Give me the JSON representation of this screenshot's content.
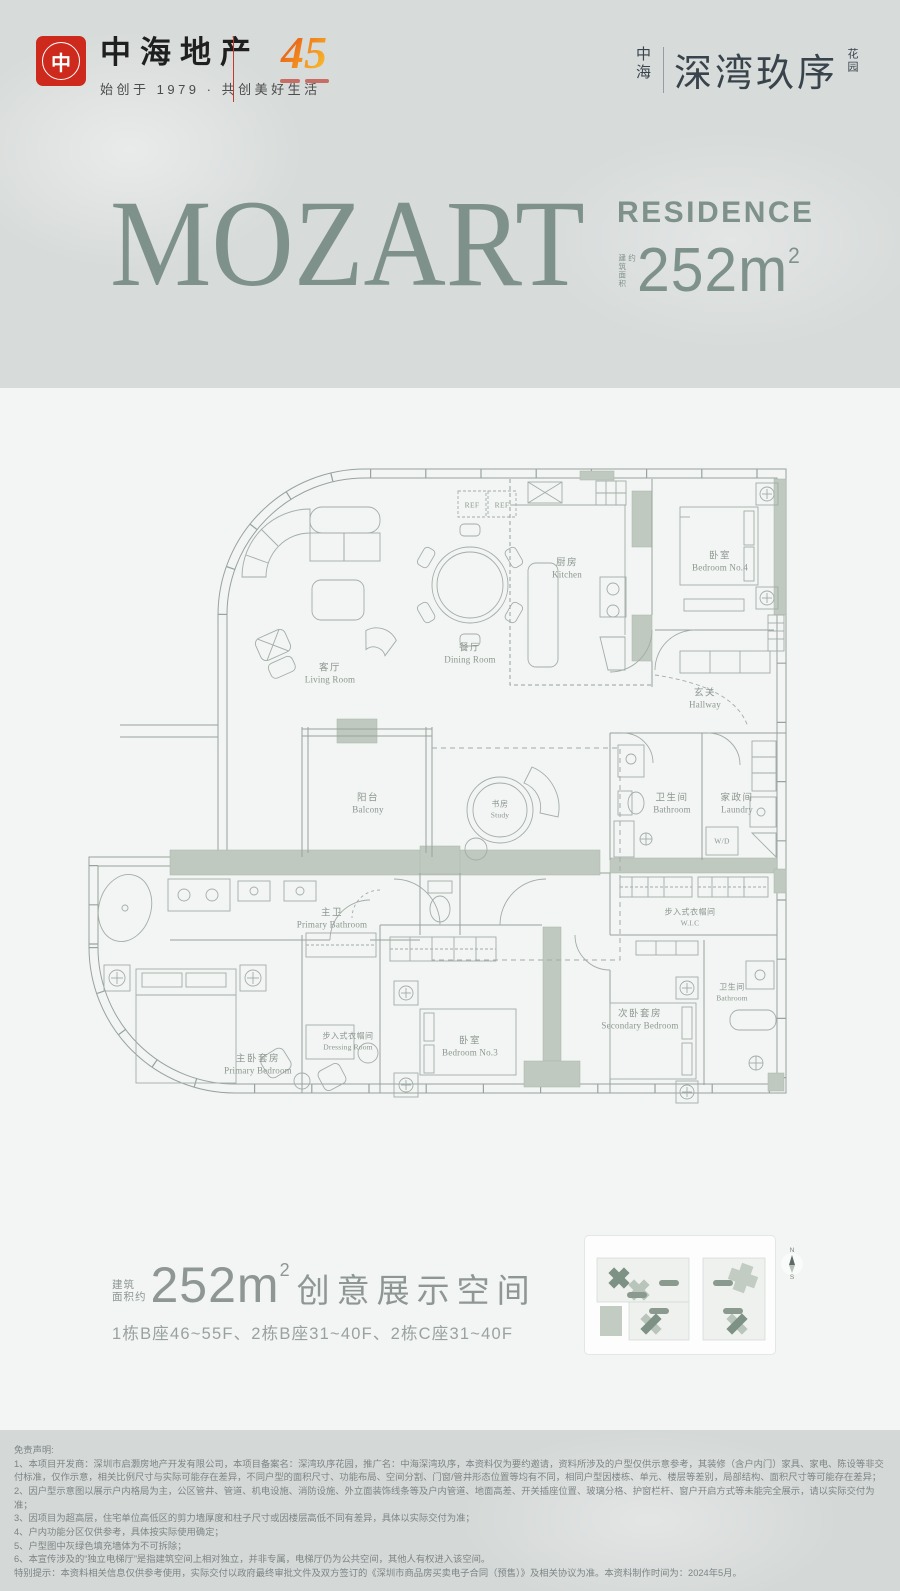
{
  "header": {
    "brand": {
      "logo_glyph": "中",
      "name": "中海地产",
      "tagline": "始创于 1979 · 共创美好生活",
      "anniversary": "45"
    },
    "project": {
      "prefix": "中海",
      "name": "深湾玖序",
      "suffix": "花园"
    }
  },
  "hero": {
    "title": "MOZART",
    "subtitle": "RESIDENCE",
    "area_label": "建筑面积约",
    "area_value": "252m",
    "area_sup": "2"
  },
  "plan": {
    "ref_label": "REF",
    "wd_label": "W/D",
    "rooms": [
      {
        "zh": "客厅",
        "en": "Living Room"
      },
      {
        "zh": "餐厅",
        "en": "Dining Room"
      },
      {
        "zh": "厨房",
        "en": "Kitchen"
      },
      {
        "zh": "卧室",
        "en": "Bedroom No.4"
      },
      {
        "zh": "玄关",
        "en": "Hallway"
      },
      {
        "zh": "阳台",
        "en": "Balcony"
      },
      {
        "zh": "书房",
        "en": "Study"
      },
      {
        "zh": "卫生间",
        "en": "Bathroom"
      },
      {
        "zh": "家政间",
        "en": "Laundry"
      },
      {
        "zh": "主卫",
        "en": "Primary Bathroom"
      },
      {
        "zh": "主卧套房",
        "en": "Primary Bedroom"
      },
      {
        "zh": "步入式衣帽间",
        "en": "Dressing Room"
      },
      {
        "zh": "卧室",
        "en": "Bedroom No.3"
      },
      {
        "zh": "次卧套房",
        "en": "Secondary Bedroom"
      },
      {
        "zh": "步入式衣帽间",
        "en": "W.I.C"
      },
      {
        "zh": "卫生间",
        "en": "Bathroom"
      }
    ]
  },
  "caption": {
    "area_label_l1": "建筑",
    "area_label_l2": "面积约",
    "area_value": "252m",
    "area_sup": "2",
    "title": "创意展示空间",
    "floors": "1栋B座46~55F、2栋B座31~40F、2栋C座31~40F"
  },
  "keyplan": {
    "north": "N",
    "south": "S"
  },
  "footer": {
    "title": "免责声明:",
    "lines": [
      "1、本项目开发商：深圳市启灏房地产开发有限公司，本项目备案名：深湾玖序花园，推广名：中海深湾玖序，本资料仅为要约邀请，资料所涉及的户型仅供示意参考，其装修（含户内门）家具、家电、陈设等非交付标准，仅作示意，相关比例尺寸与实际可能存在差异，不同户型的面积尺寸、功能布局、空间分割、门窗/管井形态位置等均有不同，相同户型因楼栋、单元、楼层等差别，局部结构、面积尺寸等可能存在差异；",
      "2、因户型示意图以展示户内格局为主，公区管井、管道、机电设施、消防设施、外立面装饰线条等及户内管道、地面高差、开关插座位置、玻璃分格、护窗栏杆、窗户开启方式等未能完全展示，请以实际交付为准；",
      "3、因项目为超高层，住宅单位高低区的剪力墙厚度和柱子尺寸或因楼层高低不同有差异，具体以实际交付为准；",
      "4、户内功能分区仅供参考，具体按实际使用确定；",
      "5、户型图中灰绿色填充墙体为不可拆除；",
      "6、本宣传涉及的“独立电梯厅”是指建筑空间上相对独立，并非专属，电梯厅仍为公共空间，其他人有权进入该空间。",
      "特别提示：本资料相关信息仅供参考使用，实际交付以政府最终审批文件及双方签订的《深圳市商品房买卖电子合同（预售）》及相关协议为准。本资料制作时间为：2024年5月。"
    ]
  }
}
